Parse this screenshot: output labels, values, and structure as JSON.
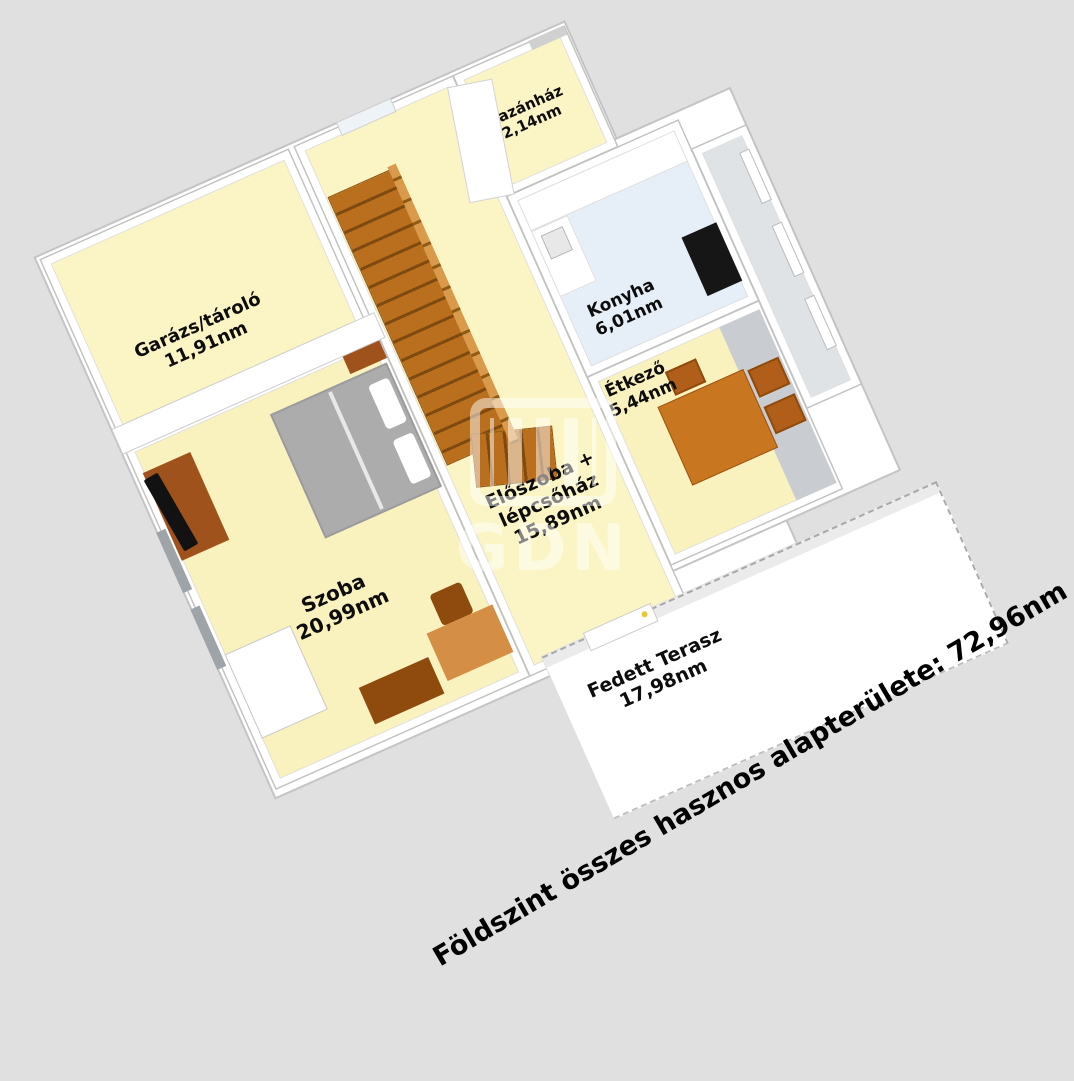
{
  "annotation": "Földszint összes hasznos alapterülete: 72,96nm",
  "watermark": "GDN",
  "rooms": {
    "garage": {
      "name": "Garázs/tároló",
      "area": "11,91nm"
    },
    "bedroom": {
      "name": "Szoba",
      "area": "20,99nm"
    },
    "hall": {
      "name_line1": "Előszoba +",
      "name_line2": "lépcsőház",
      "area": "15,89nm"
    },
    "boiler": {
      "name": "Kazánház",
      "area": "2,14nm"
    },
    "kitchen": {
      "name": "Konyha",
      "area": "6,01nm"
    },
    "dining": {
      "name": "Étkező",
      "area": "5,44nm"
    },
    "terrace": {
      "name": "Fedett Terasz",
      "area": "17,98nm"
    }
  },
  "colors": {
    "background": "#e0e0e0",
    "floor_cream": "#fbf5c6",
    "kitchen_floor": "#e6eff8",
    "wall": "#ffffff",
    "wood_brown": "#b96f1e",
    "furniture_brown": "#a0521d",
    "table_brown": "#c8761f"
  }
}
